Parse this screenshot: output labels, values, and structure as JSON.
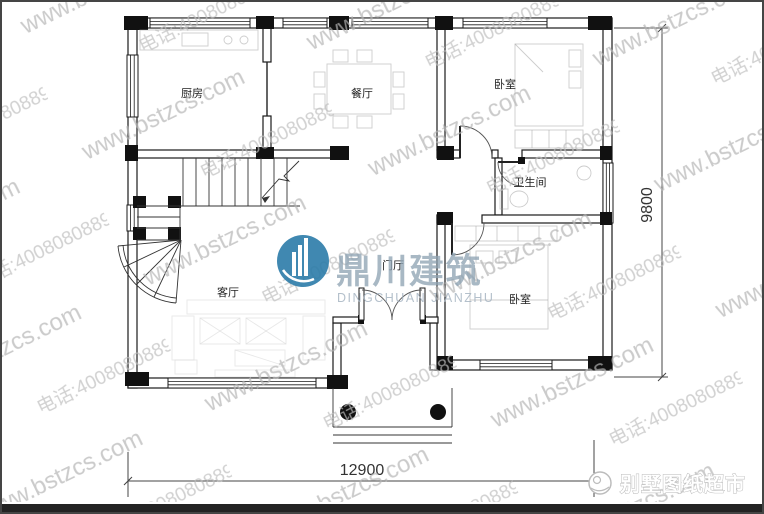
{
  "watermark": {
    "site": "www.bstzcs.com",
    "phone": "电话:4008080889"
  },
  "rooms": {
    "kitchen": "厨房",
    "dining": "餐厅",
    "bedroom_top": "卧室",
    "bathroom": "卫生间",
    "living": "客厅",
    "hall": "门厅",
    "bedroom_bottom": "卧室"
  },
  "dimensions": {
    "width_mm": "12900",
    "depth_mm": "9800"
  },
  "brand_center": {
    "cn": "鼎川建筑",
    "en": "DINGCHUAN JIANZHU",
    "circle_color": "#2c7ca9"
  },
  "brand_corner": {
    "text": "别墅图纸超市"
  },
  "frame": {
    "bottom_bar_color": "#232323"
  }
}
